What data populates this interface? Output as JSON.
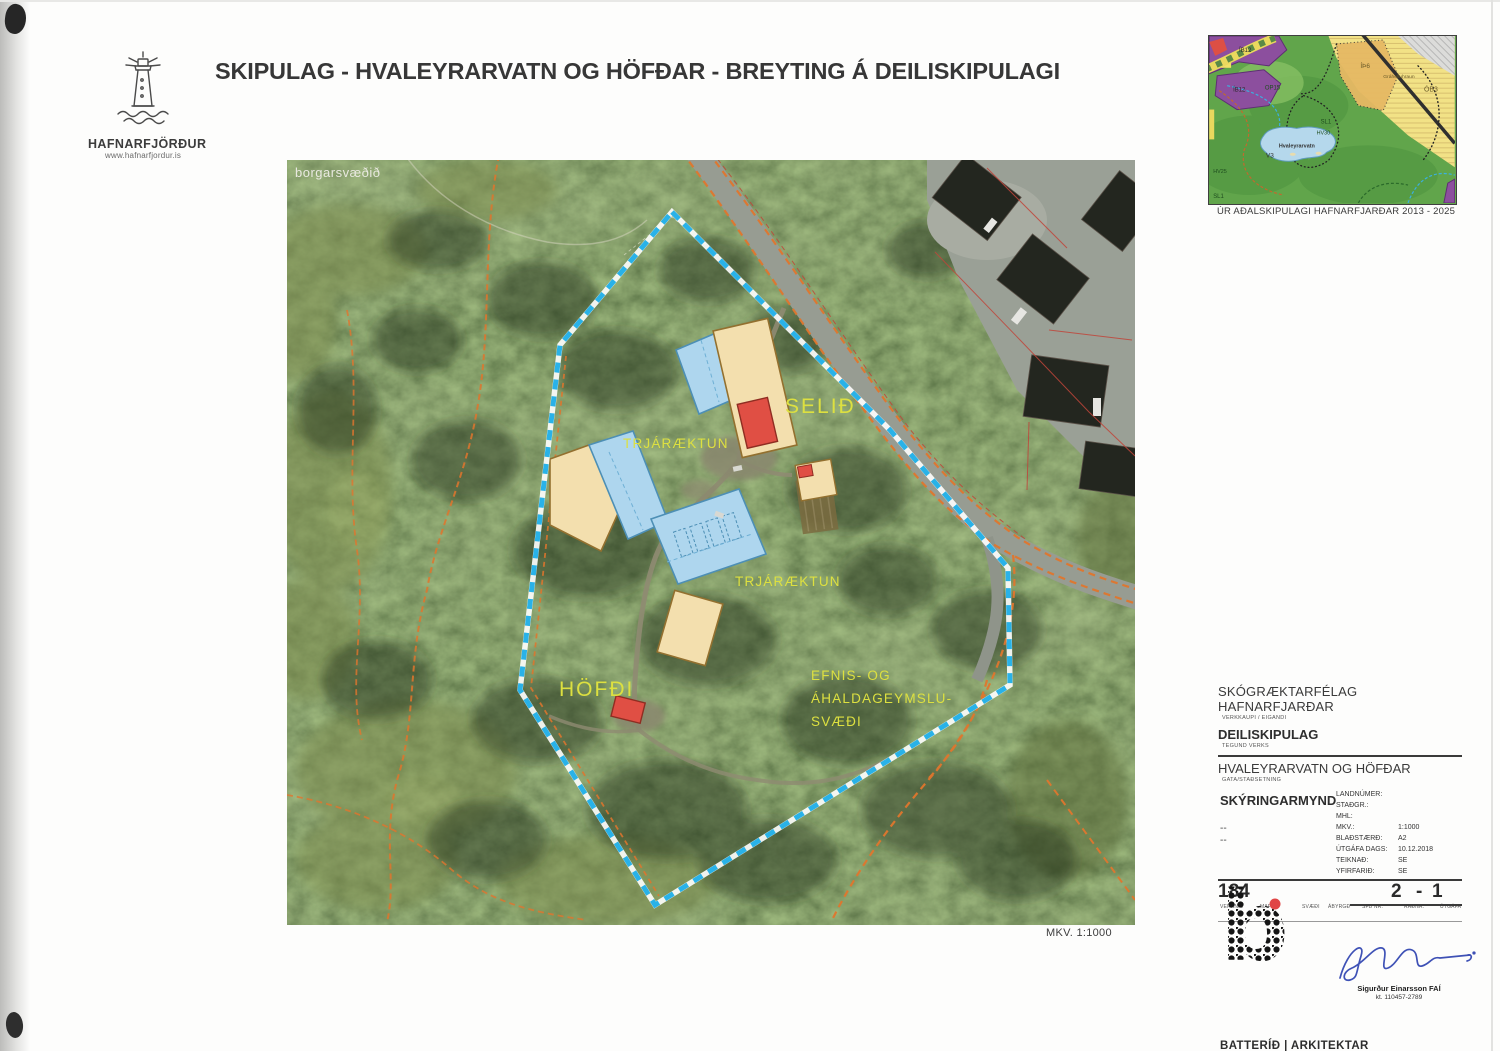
{
  "header": {
    "title": "SKIPULAG - HVALEYRARVATN OG HÖFÐAR - BREYTING Á DEILISKIPULAGI",
    "logo": {
      "name": "HAFNARFJÖRÐUR",
      "url": "www.hafnarfjordur.is"
    }
  },
  "map": {
    "corner_label": "borgarsvæðið",
    "scale_note": "MKV. 1:1000",
    "labels": {
      "selid": "SELIÐ",
      "hofdi": "HÖFÐI",
      "trjaraektun_upper": "TRJÁRÆKTUN",
      "trjaraektun_lower": "TRJÁRÆKTUN",
      "efnis1": "EFNIS- OG",
      "efnis2": "ÁHALDAGEYMSLU-",
      "efnis3": "SVÆÐI"
    },
    "colors": {
      "boundary_blue": "#29b2e8",
      "trail_orange": "#e0762e",
      "parcel_red": "#c0453a",
      "building_blue": "#aed6ee",
      "building_tan": "#f3dfae",
      "building_red": "#e04f44",
      "label_yellow": "#dde040"
    }
  },
  "inset": {
    "caption": "ÚR AÐALSKIPULAGI HAFNARFJARÐAR 2013 - 2025",
    "labels": {
      "ib12_a": "ÍB12",
      "ib12_b": "ÍB12",
      "op15": "OP15",
      "ith6": "ÍÞ6",
      "grahelluhraun": "Gráhelluhraun",
      "ob3": "ÓB3",
      "sl1": "SL1",
      "hv30": "HV30",
      "hv25": "HV25",
      "sl1_corner": "SL1",
      "lake": "Hvaleyrarvatn",
      "v3": "V3"
    }
  },
  "titleblock": {
    "client": "SKÓGRÆKTARFÉLAG HAFNARFJARÐAR",
    "client_caption": "VERKKAUPI / EIGANDI",
    "work_type": "DEILISKIPULAG",
    "work_type_caption": "TEGUND VERKS",
    "site": "HVALEYRARVATN OG HÖFÐAR",
    "site_caption": "GATA/STAÐSETNING",
    "drawing_title": "SKÝRINGARMYND",
    "note1": "--",
    "note2": "--",
    "fields": [
      {
        "label": "LANDNÚMER:",
        "value": ""
      },
      {
        "label": "STAÐGR.:",
        "value": ""
      },
      {
        "label": "MHL:",
        "value": ""
      },
      {
        "label": "MKV.:",
        "value": "1:1000"
      },
      {
        "label": "BLAÐSTÆRÐ:",
        "value": "A2"
      },
      {
        "label": "ÚTGÁFA DAGS:",
        "value": "10.12.2018"
      },
      {
        "label": "TEIKNAÐ:",
        "value": "SE"
      },
      {
        "label": "YFIRFARIÐ:",
        "value": "SE"
      }
    ],
    "verknr": "184",
    "radnr": "2",
    "dash": "-",
    "utgafa_nr": "1",
    "columns": [
      "VERKNR.",
      "MAPPA",
      "SVÆÐI",
      "ÁBYRGÐ",
      "SFB NR.",
      "RAÐNR.",
      "ÚTGÁFA"
    ],
    "logo_letter": "b",
    "signer": {
      "name": "Sigurður Einarsson FAÍ",
      "kt": "kt. 110457-2789"
    },
    "firm": "BATTERÍÐ | ARKITEKTAR",
    "contact": "Hvaleyrarbraut 32 | 220 Hafnarfirði | S: 54 54 700 | batteri@arkitekt.is | www.arkitekt.is",
    "copyright1": "© BATTERÍÐ | ARKITEKTAR",
    "copyright2": "ÖLL AFNOT OG AFRITUN TEIKNINGAR AÐ HLUTA EÐA Í HEILD ER HÁÐ SKRIFLEGU LEYFI HÖFUNDA"
  }
}
